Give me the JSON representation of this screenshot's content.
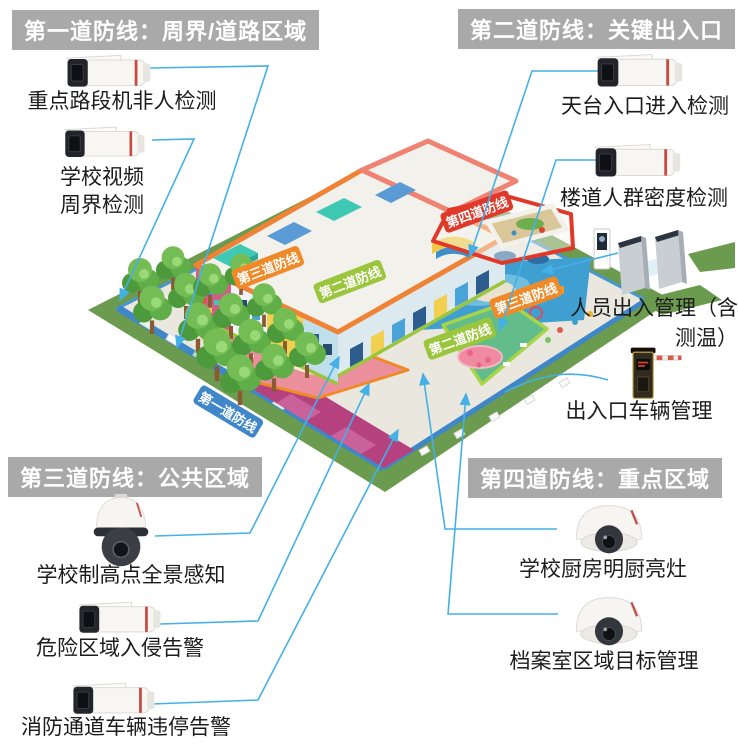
{
  "sections": [
    {
      "title": "第一道防线：周界/道路区域",
      "items": [
        {
          "label": "重点路段机非人检测",
          "device": "bullet-camera"
        },
        {
          "label_lines": [
            "学校视频",
            "周界检测"
          ],
          "device": "bullet-camera"
        }
      ]
    },
    {
      "title": "第二道防线：关键出入口",
      "items": [
        {
          "label": "天台入口进入检测",
          "device": "bullet-camera"
        },
        {
          "label": "楼道人群密度检测",
          "device": "bullet-camera"
        },
        {
          "label_lines": [
            "人员出入管理（含",
            "测温）"
          ],
          "device": "turnstile-gate"
        },
        {
          "label": "出入口车辆管理",
          "device": "barrier-gate"
        }
      ]
    },
    {
      "title": "第三道防线：公共区域",
      "items": [
        {
          "label": "学校制高点全景感知",
          "device": "ptz-dome-camera"
        },
        {
          "label": "危险区域入侵告警",
          "device": "bullet-camera"
        },
        {
          "label": "消防通道车辆违停告警",
          "device": "bullet-camera"
        }
      ]
    },
    {
      "title": "第四道防线：重点区域",
      "items": [
        {
          "label": "学校厨房明厨亮灶",
          "device": "dome-camera"
        },
        {
          "label": "档案室区域目标管理",
          "device": "dome-camera"
        }
      ]
    }
  ],
  "map": {
    "banners": {
      "line1": "第一道防线",
      "line2": "第二道防线",
      "line3": "第三道防线",
      "line4": "第四道防线"
    }
  },
  "colors": {
    "header_bg": "#a9a9a9",
    "header_text": "#ffffff",
    "connector": "#45b0e6",
    "banner_line1": "#3f87c8",
    "banner_line2": "#9bc53d",
    "banner_line3": "#f08a28",
    "banner_line4": "#e0392a"
  }
}
